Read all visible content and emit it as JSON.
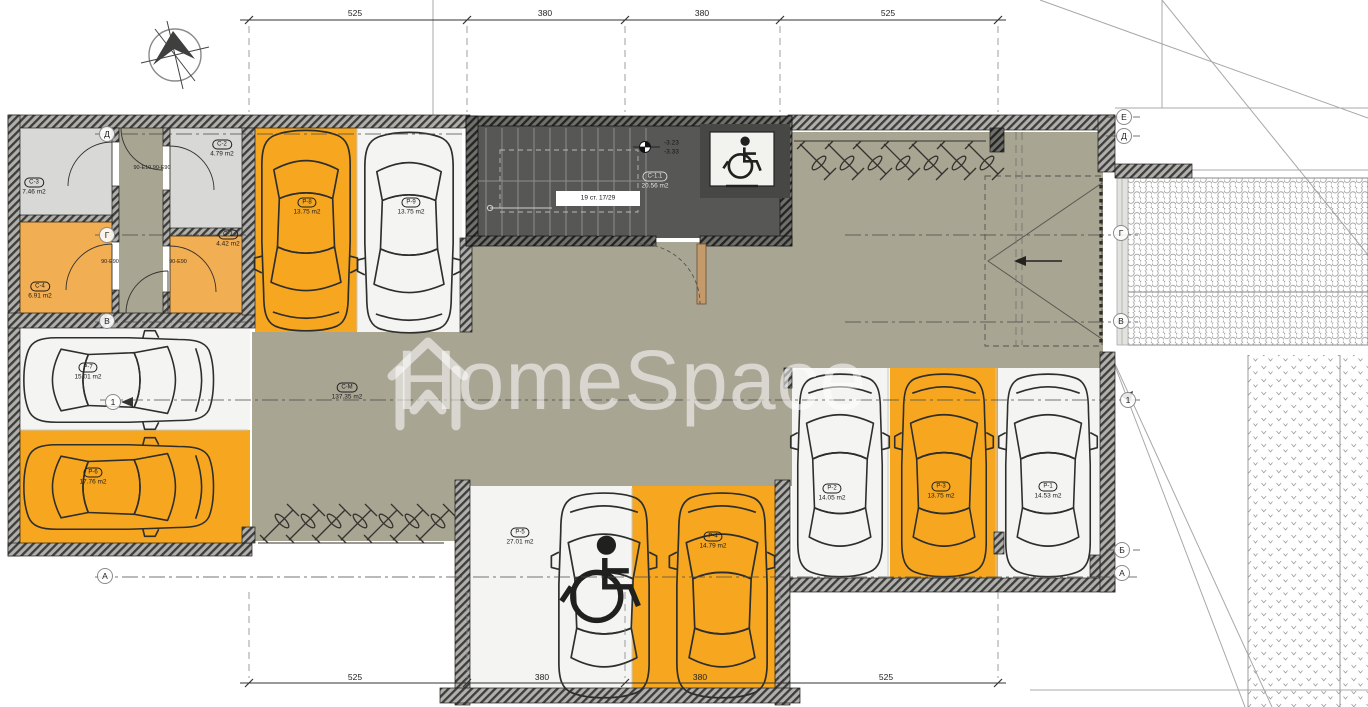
{
  "watermark": {
    "brand": "HomeSpace"
  },
  "dimensions": {
    "top": [
      "525",
      "380",
      "380",
      "525"
    ],
    "bottom": [
      "525",
      "380",
      "380",
      "525"
    ]
  },
  "axis_markers": {
    "left": [
      "Д",
      "Г",
      "В",
      "1",
      "А"
    ],
    "right": [
      "Е",
      "Д",
      "Г",
      "В",
      "1",
      "Б",
      "А"
    ]
  },
  "rooms": {
    "s3": {
      "code": "С-3",
      "area": "7.46 m2"
    },
    "s2": {
      "code": "С-2",
      "area": "4.79 m2"
    },
    "s4": {
      "code": "С-4",
      "area": "6.91 m2"
    },
    "s1": {
      "code": "С-1",
      "area": "4.42 m2"
    },
    "lobby": {
      "code": "С-1.1",
      "area": "20.56 m2"
    },
    "maneuver": {
      "code": "С-М",
      "area": "137.35 m2"
    }
  },
  "parking": {
    "p1": {
      "code": "Р-1",
      "area": "14.53 m2"
    },
    "p2": {
      "code": "Р-2",
      "area": "14.05 m2"
    },
    "p3": {
      "code": "Р-3",
      "area": "13.75 m2"
    },
    "p4": {
      "code": "Р-4",
      "area": "14.79 m2"
    },
    "p5": {
      "code": "Р-5",
      "area": "27.01 m2"
    },
    "p6": {
      "code": "Р-6",
      "area": "17.76 m2"
    },
    "p7": {
      "code": "Р-7",
      "area": "15.01 m2"
    },
    "p8": {
      "code": "Р-8",
      "area": "13.75 m2"
    },
    "p9": {
      "code": "Р-9",
      "area": "13.75 m2"
    }
  },
  "stairs": {
    "label": "19 ст. 17/29"
  },
  "levels": {
    "upper": "-3.23",
    "lower": "-3.33"
  },
  "doors": {
    "corridor_top": "90-Е10 90-Е90",
    "door_left": "90-Е90",
    "door_right": "90-Е90"
  },
  "colors": {
    "driveway": "#a8a593",
    "stall_orange": "#f6a71f",
    "room_orange": "#f2ae52",
    "room_gray": "#d8d8d6",
    "stair_dark": "#575755"
  }
}
